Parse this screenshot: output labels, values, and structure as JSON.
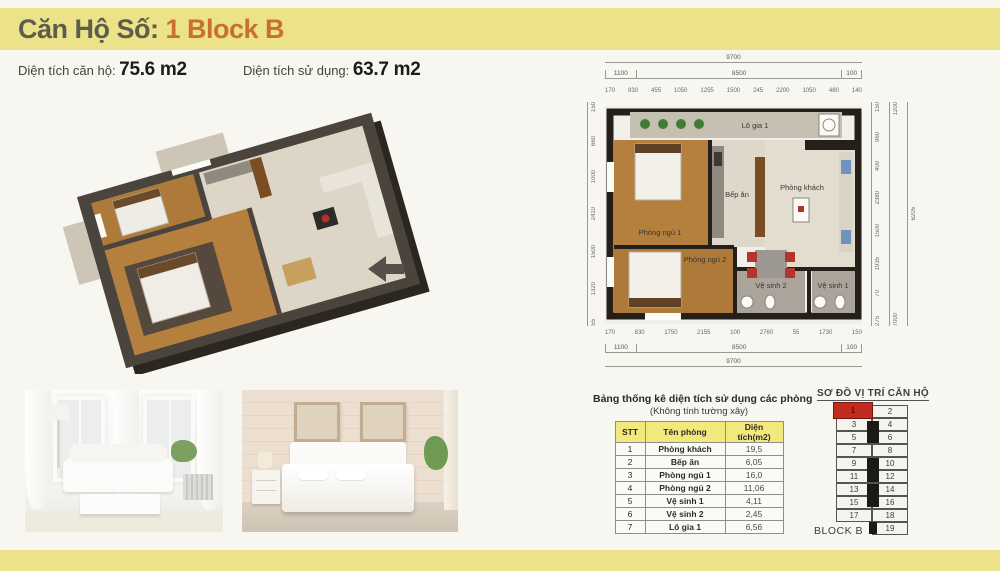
{
  "header": {
    "title_prefix": "Căn Hộ Số: ",
    "title_highlight": "1 Block B"
  },
  "areas": {
    "unit_area_label": "Diện tích căn hộ: ",
    "unit_area_value": "75.6 m2",
    "usable_area_label": "Diện tích sử dụng: ",
    "usable_area_value": "63.7 m2"
  },
  "floorplan": {
    "rooms": {
      "balcony": "Lô gia 1",
      "kitchen": "Bếp ăn",
      "living": "Phòng khách",
      "bedroom1": "Phòng ngủ 1",
      "bedroom2": "Phòng ngủ 2",
      "bath1": "Vệ sinh 1",
      "bath2": "Vệ sinh 2"
    },
    "dims": {
      "top_total": "9700",
      "top_mid": [
        "1100",
        "8500",
        "100"
      ],
      "top_small": [
        "170",
        "830",
        "455",
        "1050",
        "1255",
        "1500",
        "245",
        "2200",
        "1050",
        "480",
        "140"
      ],
      "bottom_small": [
        "170",
        "830",
        "1750",
        "2155",
        "100",
        "2760",
        "55",
        "1730",
        "150"
      ],
      "bottom_mid": [
        "1100",
        "8500",
        "100"
      ],
      "bottom_total": "9700",
      "left_side": [
        "150",
        "660",
        "1000",
        "2410",
        "1500",
        "1320",
        "55"
      ],
      "right_side": [
        "150",
        "960",
        "400",
        "2380",
        "1500",
        "1935",
        "70",
        "275"
      ],
      "right_mid": [
        "1200",
        "7000"
      ],
      "right_total": "6205"
    }
  },
  "stats_table": {
    "title": "Bảng thống kê diện tích sử dụng các phòng",
    "subtitle": "(Không tính tường xây)",
    "headers": [
      "STT",
      "Tên phòng",
      "Diện tích(m2)"
    ],
    "rows": [
      [
        "1",
        "Phòng khách",
        "19,5"
      ],
      [
        "2",
        "Bếp ăn",
        "6,05"
      ],
      [
        "3",
        "Phòng ngủ 1",
        "16,0"
      ],
      [
        "4",
        "Phòng ngủ 2",
        "11,06"
      ],
      [
        "5",
        "Vệ sinh 1",
        "4,11"
      ],
      [
        "6",
        "Vệ sinh 2",
        "2,45"
      ],
      [
        "7",
        "Lô gia 1",
        "6,56"
      ]
    ]
  },
  "location": {
    "title": "SƠ ĐỒ VỊ TRÍ CĂN HỘ",
    "block_label": "BLOCK B",
    "highlighted_unit": "1",
    "left_units": [
      "1",
      "3",
      "5",
      "7",
      "9",
      "11",
      "13",
      "15",
      "17"
    ],
    "right_units": [
      "2",
      "4",
      "6",
      "8",
      "10",
      "12",
      "14",
      "16",
      "18",
      "19"
    ]
  },
  "colors": {
    "band_yellow": "#ece28a",
    "accent_orange": "#c9702e",
    "highlight_red": "#c32b22",
    "table_header_yellow": "#f3e87e"
  }
}
